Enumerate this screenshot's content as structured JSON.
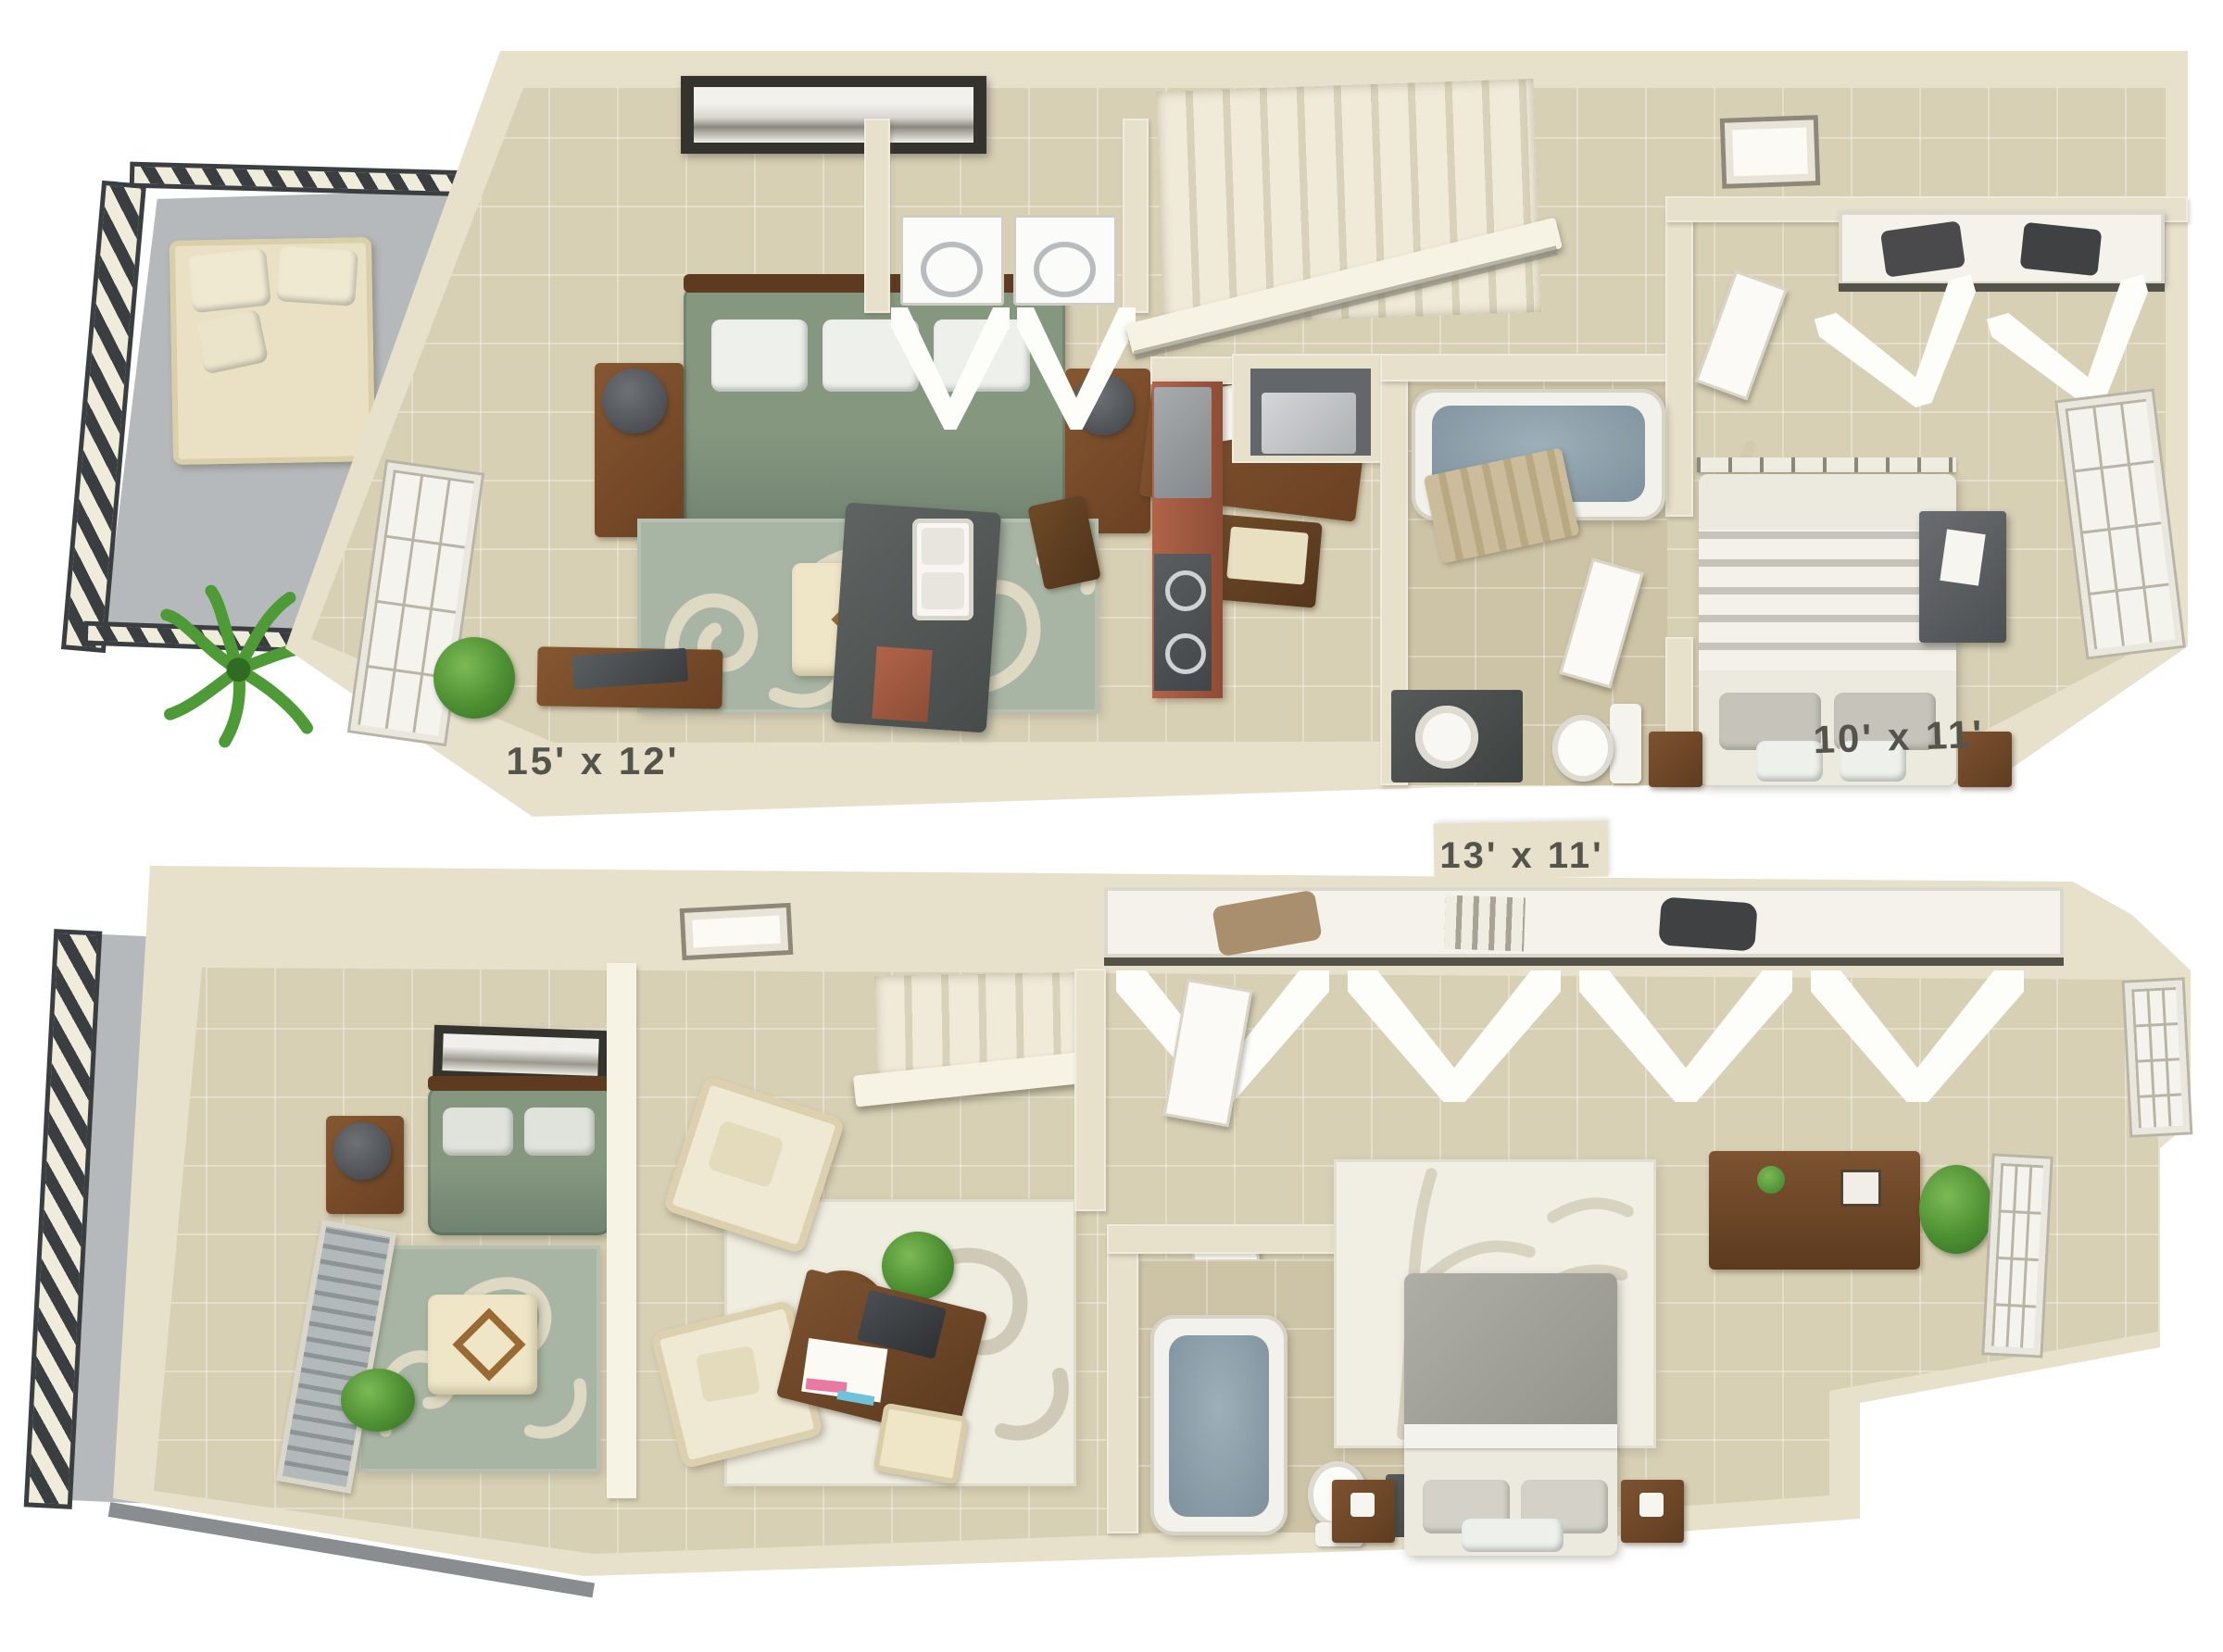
{
  "page": {
    "background": "#ffffff",
    "description": "3D isometric two-level apartment floor plan rendering"
  },
  "colors": {
    "wall": "#e7e1cc",
    "wall_highlight": "#f6f2e4",
    "wall_shadow": "#cfc8ae",
    "floor_tan": "#d8d0b5",
    "floor_bath": "#cdc3a6",
    "balcony_floor": "#b6b9bb",
    "railing_dark": "#3b3e41",
    "railing_light": "#f0ecdc",
    "rug_sage": "#a8b5a4",
    "rug_flourish": "#ded9c3",
    "sofa_green": "#85977f",
    "wood_brown": "#7a4f2d",
    "counter_dark": "#575c5b",
    "cabinet_red": "#a05a41",
    "tub_water": "#8da0ab",
    "bed_linen": "#eceadf",
    "dresser_gray": "#5d6063",
    "plant_green": "#58a13d",
    "label_text": "#55544c"
  },
  "floors": [
    {
      "name": "upper-level",
      "labels": [
        {
          "text": "15' x 12'",
          "room": "living-room"
        },
        {
          "text": "10' x 11'",
          "room": "bedroom"
        }
      ],
      "rooms": [
        "balcony",
        "living-room",
        "kitchen",
        "laundry-closet",
        "hallway",
        "stairs",
        "bathroom",
        "bedroom",
        "closet"
      ],
      "furniture": [
        "outdoor-sofa",
        "palm-plant",
        "green-sofa",
        "side-tables-with-lamps",
        "area-rug",
        "ottoman",
        "wall-art",
        "console-desk",
        "potted-plant",
        "kitchen-island-with-sink",
        "refrigerator",
        "range",
        "red-cabinets",
        "washer",
        "dryer",
        "water-heater",
        "bathtub",
        "toilet",
        "vanity-sink",
        "bed",
        "nightstands",
        "dresser",
        "closet-shelf",
        "bifold-doors",
        "windows",
        "skylight"
      ]
    },
    {
      "name": "lower-level",
      "labels": [
        {
          "text": "13' x 11'",
          "room": "bedroom"
        }
      ],
      "rooms": [
        "balcony",
        "living-area",
        "sitting-area",
        "stairs",
        "hallway",
        "bathroom",
        "bedroom",
        "closet"
      ],
      "furniture": [
        "green-sofa",
        "side-table-with-lamp",
        "area-rug",
        "ottoman",
        "wall-art",
        "window-blinds",
        "armchairs",
        "round-coffee-table",
        "cream-rug",
        "writing-desk",
        "stool",
        "potted-plants",
        "bathtub",
        "toilet",
        "vanity",
        "bed",
        "bamboo-rug",
        "nightstands",
        "dresser",
        "closet-shelf",
        "bifold-doors",
        "windows",
        "skylight"
      ]
    }
  ]
}
